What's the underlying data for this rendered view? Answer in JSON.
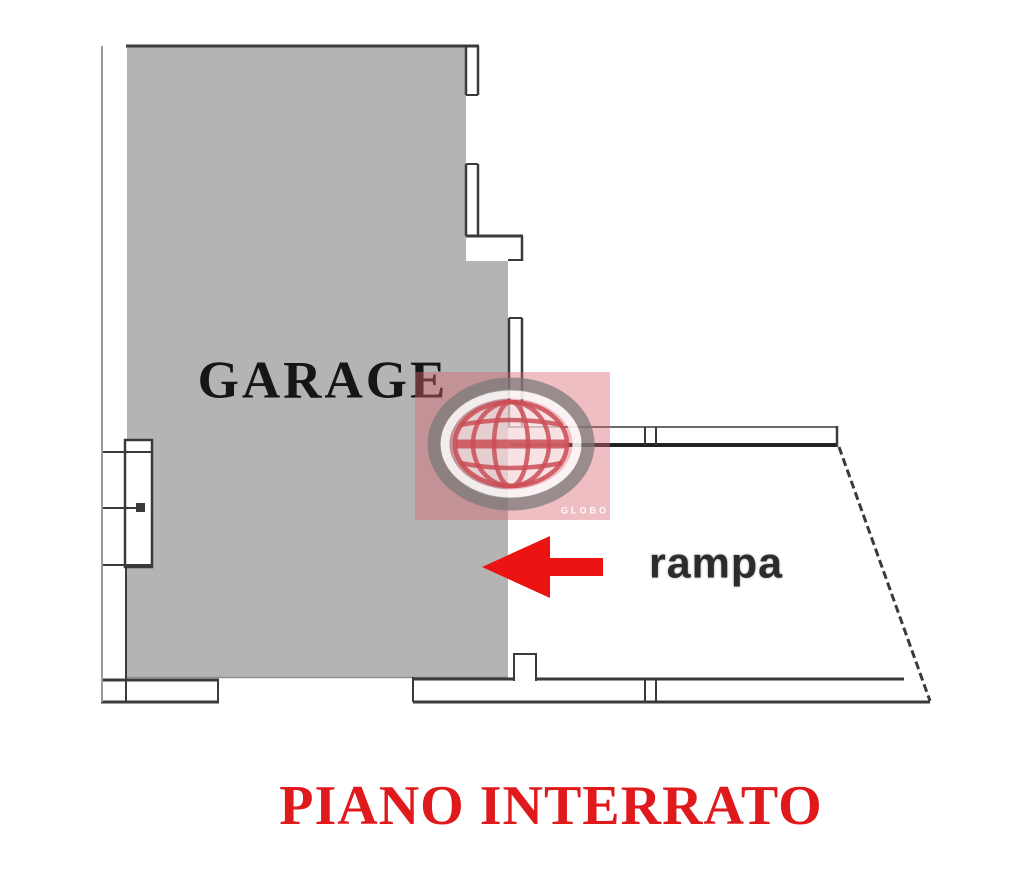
{
  "plan": {
    "title": "PIANO INTERRATO",
    "rooms": {
      "garage_label": "GARAGE",
      "ramp_label": "rampa"
    },
    "colors": {
      "room_fill": "#b4b4b4",
      "wall_line": "#3a3a3a",
      "title_red": "#e01a1c",
      "arrow_red": "#ec1313",
      "watermark_pink": "rgba(217,100,110,0.42)"
    }
  },
  "watermark": {
    "brand": "GLOBO"
  },
  "arrow": {
    "direction": "left"
  }
}
